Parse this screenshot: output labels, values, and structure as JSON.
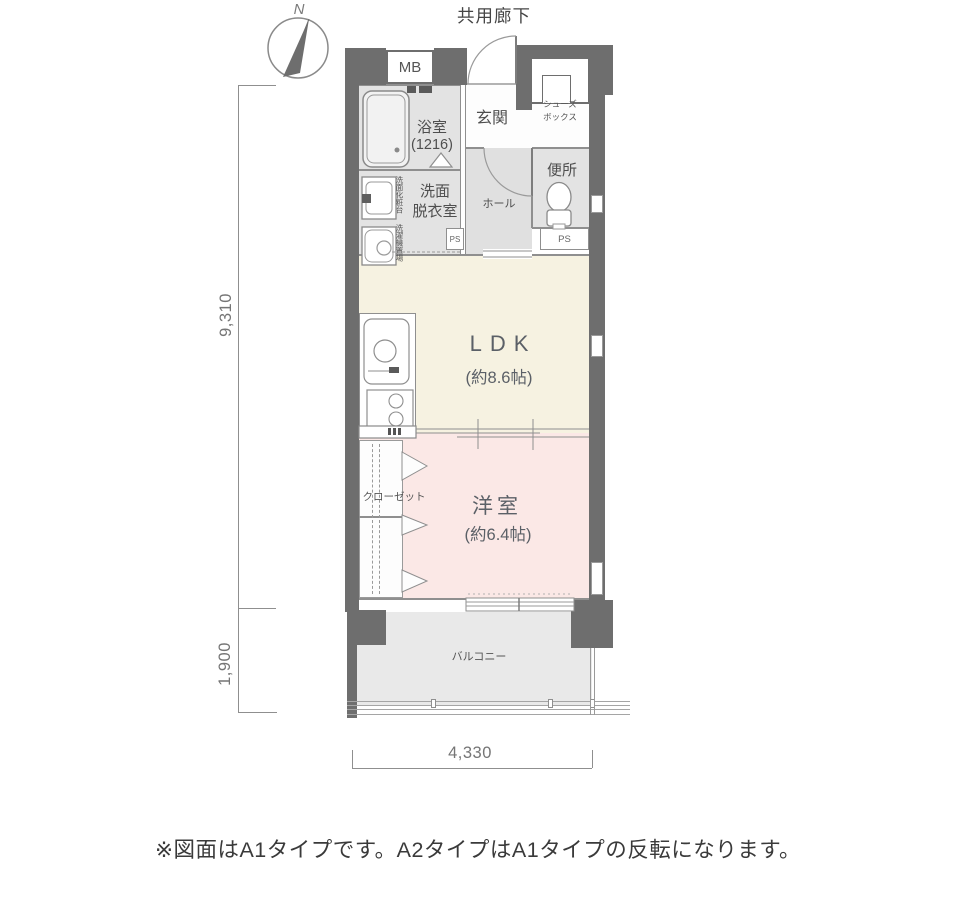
{
  "header": {
    "common_corridor_label": "共用廊下",
    "north_label": "N"
  },
  "rooms": {
    "bath": {
      "label": "浴室",
      "size": "(1216)"
    },
    "washroom": {
      "label_line1": "洗面",
      "label_line2": "脱衣室"
    },
    "vanity_label": "洗面化粧台",
    "laundry_label": "洗濯機置場",
    "entrance": {
      "label": "玄関"
    },
    "shoe_box": {
      "label_line1": "シューズ",
      "label_line2": "ボックス"
    },
    "hall": {
      "label": "ホール"
    },
    "toilet": {
      "label": "便所"
    },
    "meter_box": {
      "label": "MB"
    },
    "pipe_space_left": {
      "label": "PS"
    },
    "pipe_space_right": {
      "label": "PS"
    },
    "ldk": {
      "label": "LDK",
      "size": "(約8.6帖)"
    },
    "western_room": {
      "label": "洋室",
      "size": "(約6.4帖)"
    },
    "closet": {
      "label": "クローゼット"
    },
    "balcony": {
      "label": "バルコニー"
    }
  },
  "dimensions": {
    "vertical_main": "9,310",
    "vertical_balcony": "1,900",
    "horizontal": "4,330"
  },
  "caption": "※図面はA1タイプです。A2タイプはA1タイプの反転になります。",
  "colors": {
    "wall": "#6e6e6e",
    "ldk_fill": "#f6f2e1",
    "western_fill": "#fbe8e6",
    "wet_area_fill": "#e3e3e3",
    "balcony_fill": "#e9e9e9"
  }
}
